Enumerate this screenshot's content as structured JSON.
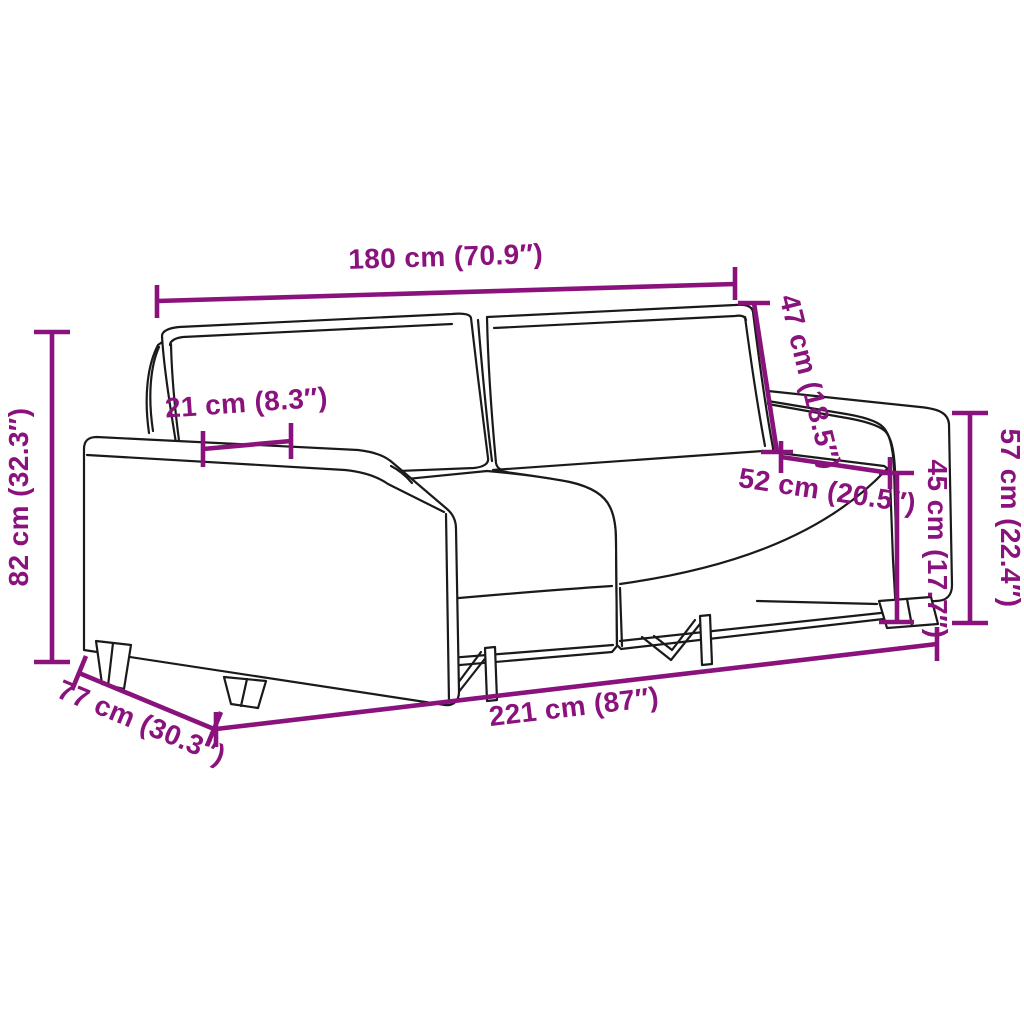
{
  "diagram": {
    "subject": "sofa-dimension-line-drawing",
    "colors": {
      "accent": "#8A127C",
      "ink": "#1A1A1A",
      "bg": "#FFFFFF"
    },
    "dimensions": {
      "overall_width": {
        "label": "180 cm (70.9″)",
        "cm": 180,
        "inches": 70.9
      },
      "backrest_height": {
        "label": "47 cm (18.5″)",
        "cm": 47,
        "inches": 18.5
      },
      "seat_depth": {
        "label": "52 cm (20.5″)",
        "cm": 52,
        "inches": 20.5
      },
      "seat_height": {
        "label": "45 cm (17.7″)",
        "cm": 45,
        "inches": 17.7
      },
      "armrest_height": {
        "label": "57 cm (22.4″)",
        "cm": 57,
        "inches": 22.4
      },
      "overall_height": {
        "label": "82 cm (32.3″)",
        "cm": 82,
        "inches": 32.3
      },
      "armrest_width": {
        "label": "21 cm (8.3″)",
        "cm": 21,
        "inches": 8.3
      },
      "overall_length": {
        "label": "221 cm (87″)",
        "cm": 221,
        "inches": 87
      },
      "overall_depth": {
        "label": "77 cm (30.3″)",
        "cm": 77,
        "inches": 30.3
      }
    }
  }
}
